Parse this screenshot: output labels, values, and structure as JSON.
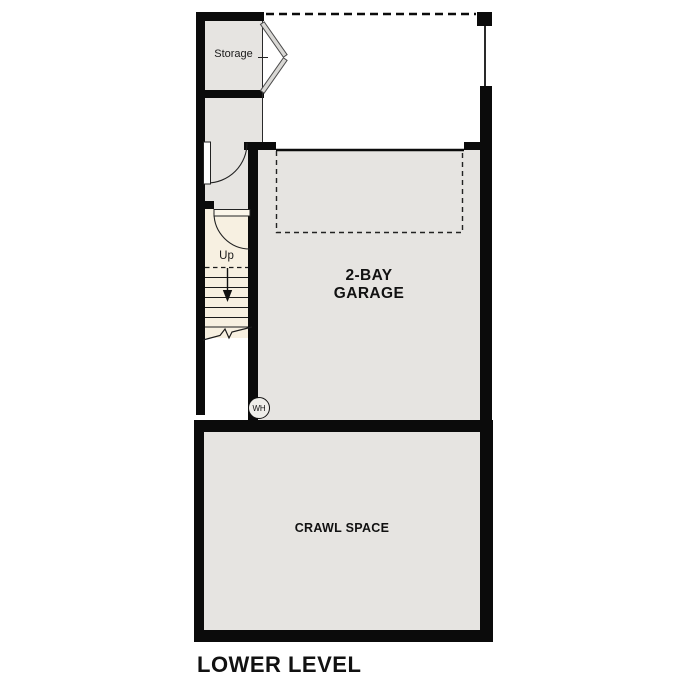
{
  "title": "LOWER LEVEL",
  "rooms": {
    "storage": {
      "label": "Storage"
    },
    "garage": {
      "label": "2-BAY\nGARAGE"
    },
    "crawl_space": {
      "label": "CRAWL SPACE"
    }
  },
  "stairs": {
    "up_label": "Up"
  },
  "fixtures": {
    "water_heater": {
      "label": "WH"
    }
  },
  "colors": {
    "floor_gray": "#e6e4e1",
    "stair_cream": "#f7f0e1",
    "wall_black": "#0b0b0b"
  }
}
